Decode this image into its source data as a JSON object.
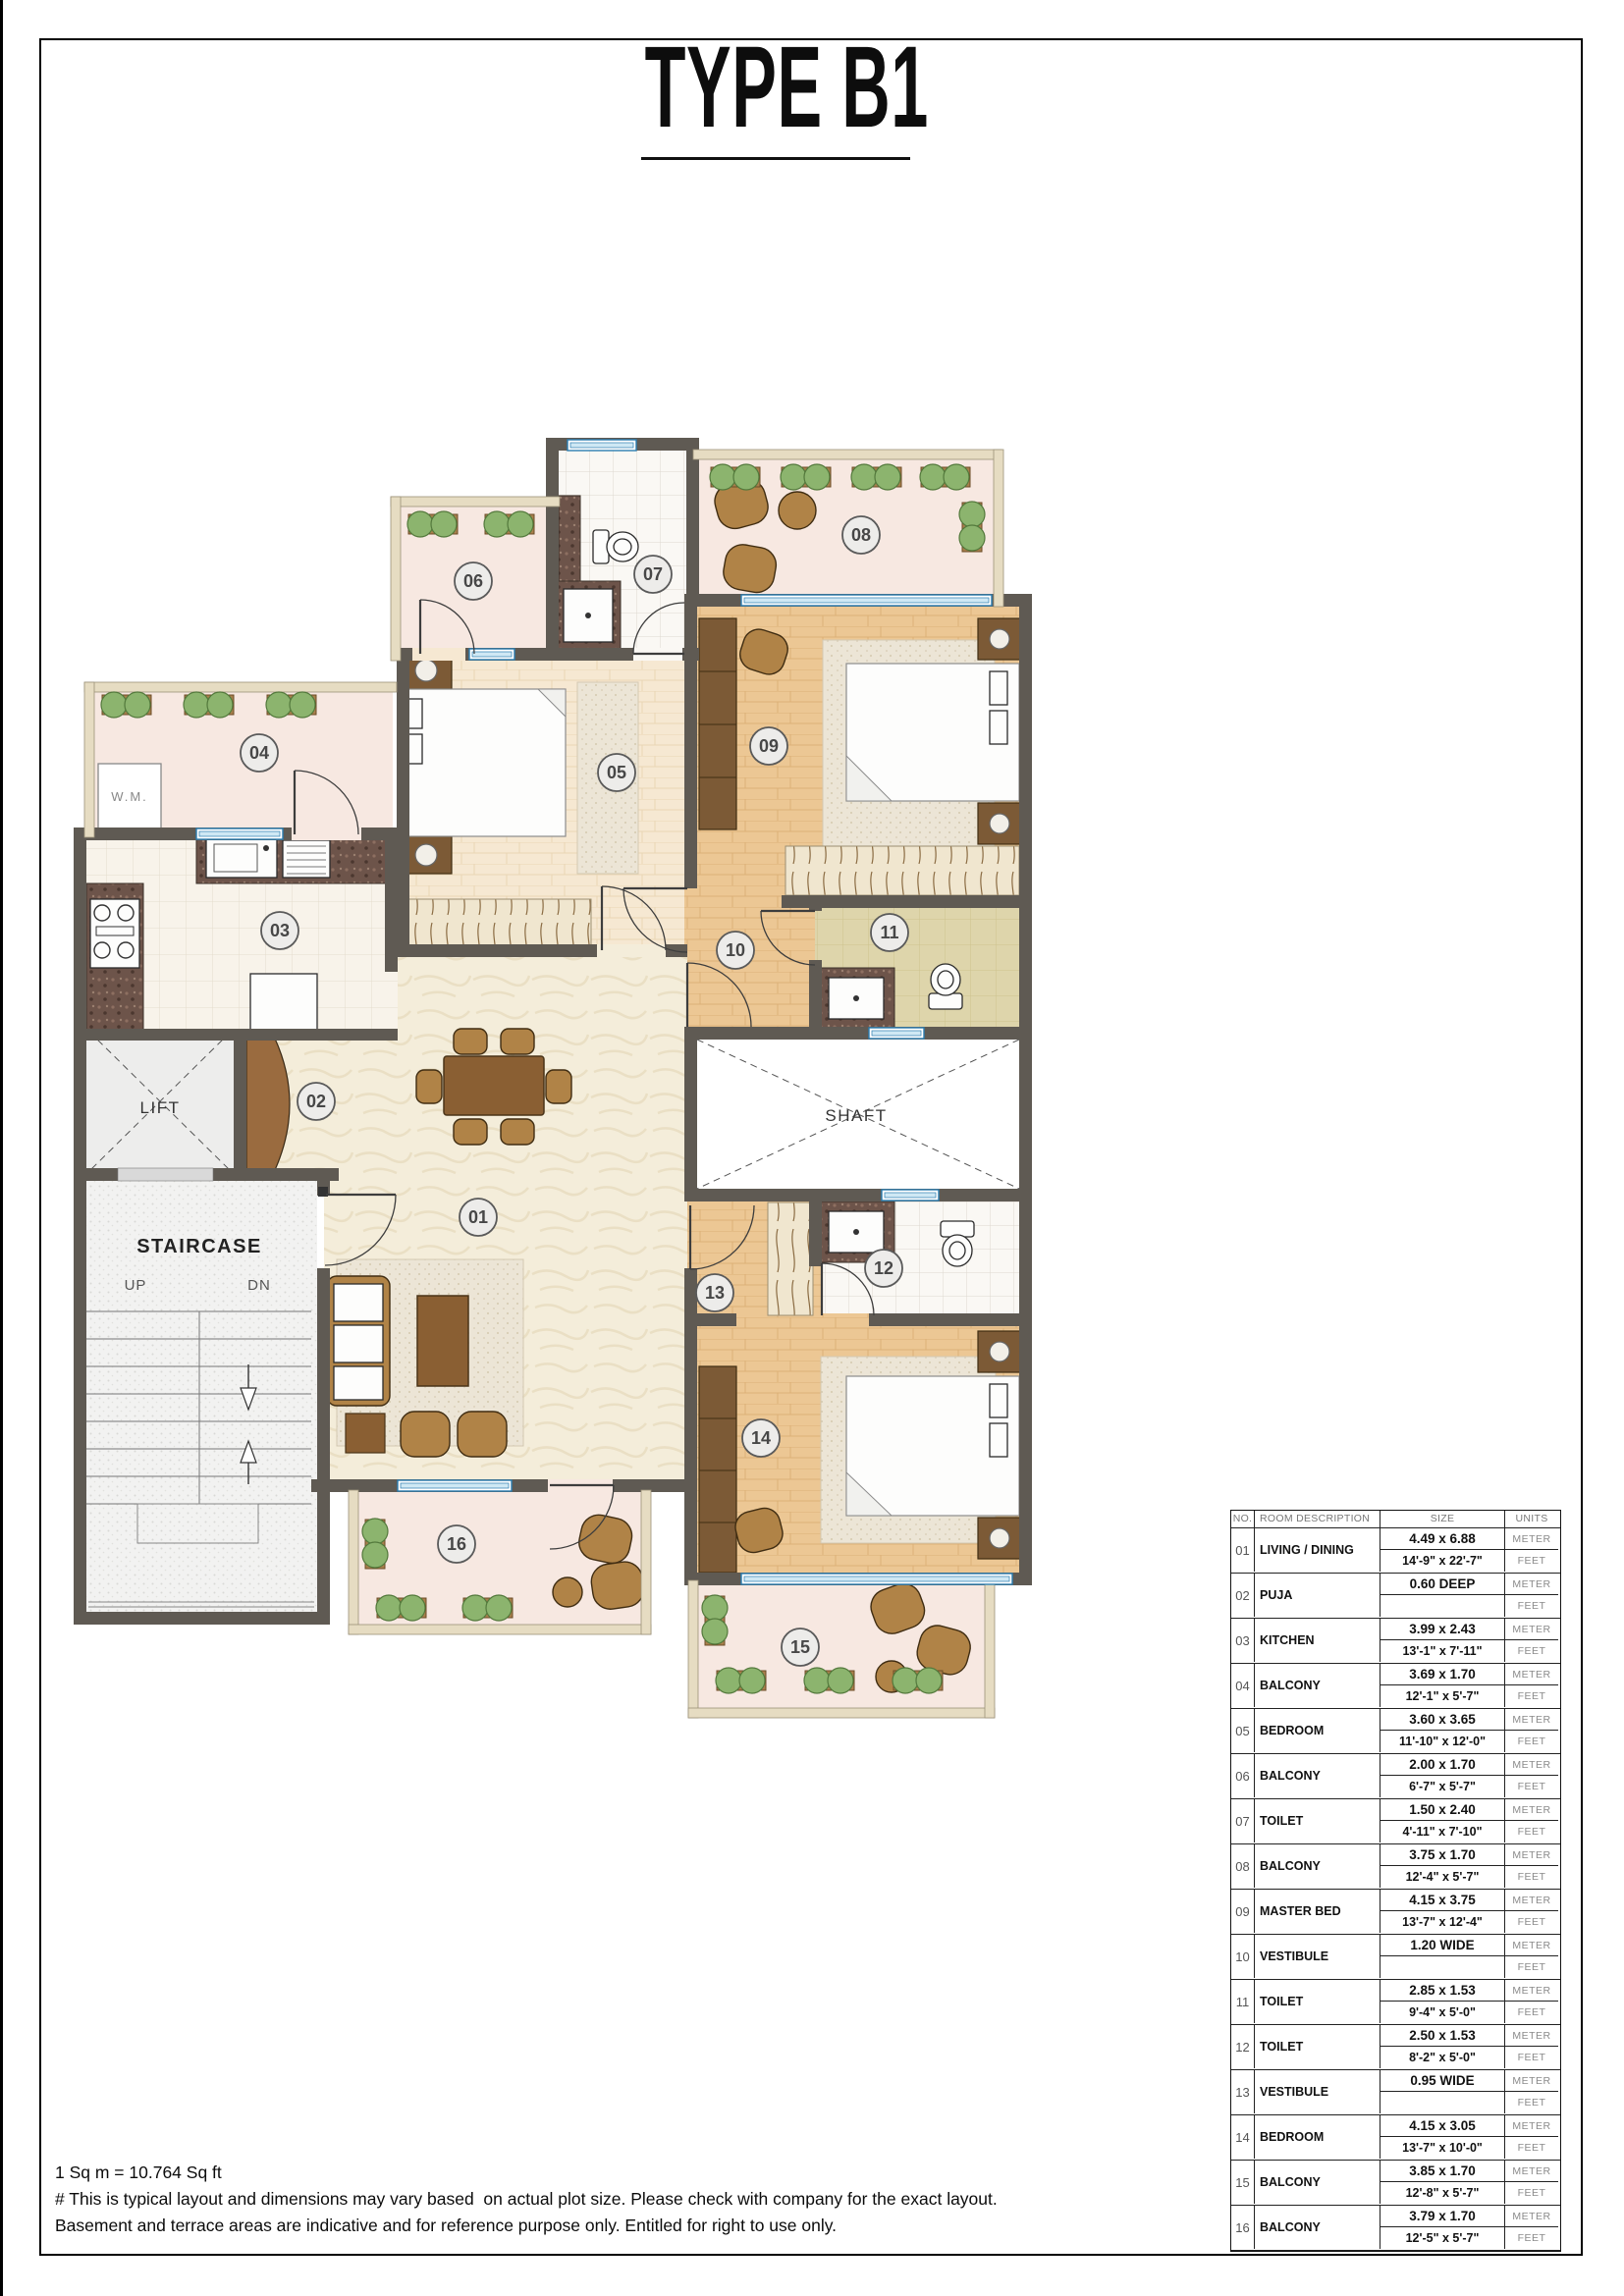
{
  "page": {
    "title": "TYPE B1",
    "footnotes": [
      "1 Sq m = 10.764 Sq ft",
      "# This is typical layout and dimensions may vary based  on actual plot size. Please check with company for the exact layout.",
      "Basement and terrace areas are indicative and for reference purpose only. Entitled for right to use only."
    ]
  },
  "plan": {
    "room_numbers": [
      "01",
      "02",
      "03",
      "04",
      "05",
      "06",
      "07",
      "08",
      "09",
      "10",
      "11",
      "12",
      "13",
      "14",
      "15",
      "16"
    ],
    "labels": {
      "lift": "LIFT",
      "staircase": "STAIRCASE",
      "up": "UP",
      "dn": "DN",
      "shaft": "SHAFT",
      "wm": "W.M."
    }
  },
  "table": {
    "headers": {
      "no": "NO.",
      "room": "ROOM DESCRIPTION",
      "size": "SIZE",
      "units": "UNITS"
    },
    "unit_meter": "METER",
    "unit_feet": "FEET",
    "rows": [
      {
        "no": "01",
        "room": "LIVING / DINING",
        "meter": "4.49 x 6.88",
        "feet": "14'-9\" x 22'-7\""
      },
      {
        "no": "02",
        "room": "PUJA",
        "meter": "0.60 DEEP",
        "feet": ""
      },
      {
        "no": "03",
        "room": "KITCHEN",
        "meter": "3.99 x 2.43",
        "feet": "13'-1\" x 7'-11\""
      },
      {
        "no": "04",
        "room": "BALCONY",
        "meter": "3.69 x 1.70",
        "feet": "12'-1\" x 5'-7\""
      },
      {
        "no": "05",
        "room": "BEDROOM",
        "meter": "3.60 x 3.65",
        "feet": "11'-10\" x 12'-0\""
      },
      {
        "no": "06",
        "room": "BALCONY",
        "meter": "2.00 x 1.70",
        "feet": "6'-7\" x 5'-7\""
      },
      {
        "no": "07",
        "room": "TOILET",
        "meter": "1.50 x 2.40",
        "feet": "4'-11\" x 7'-10\""
      },
      {
        "no": "08",
        "room": "BALCONY",
        "meter": "3.75 x 1.70",
        "feet": "12'-4\" x 5'-7\""
      },
      {
        "no": "09",
        "room": "MASTER BED",
        "meter": "4.15 x 3.75",
        "feet": "13'-7\" x 12'-4\""
      },
      {
        "no": "10",
        "room": "VESTIBULE",
        "meter": "1.20 WIDE",
        "feet": ""
      },
      {
        "no": "11",
        "room": "TOILET",
        "meter": "2.85 x 1.53",
        "feet": "9'-4\" x 5'-0\""
      },
      {
        "no": "12",
        "room": "TOILET",
        "meter": "2.50 x 1.53",
        "feet": "8'-2\" x 5'-0\""
      },
      {
        "no": "13",
        "room": "VESTIBULE",
        "meter": "0.95 WIDE",
        "feet": ""
      },
      {
        "no": "14",
        "room": "BEDROOM",
        "meter": "4.15 x 3.05",
        "feet": "13'-7\" x 10'-0\""
      },
      {
        "no": "15",
        "room": "BALCONY",
        "meter": "3.85 x 1.70",
        "feet": "12'-8\" x 5'-7\""
      },
      {
        "no": "16",
        "room": "BALCONY",
        "meter": "3.79 x 1.70",
        "feet": "12'-5\" x 5'-7\""
      }
    ]
  },
  "colors": {
    "wall": "#5f5a53",
    "balcony_floor": "#f7e8e1",
    "wood_floor": "#ecc794",
    "wood_floor_light": "#f6e8d2",
    "living_floor": "#f4edda",
    "toilet_tile": "#ded5ab",
    "window_blue": "#2b7db0",
    "plant_green": "#8cb46e",
    "furniture_wood": "#b08347",
    "granite": "#6d544a"
  }
}
